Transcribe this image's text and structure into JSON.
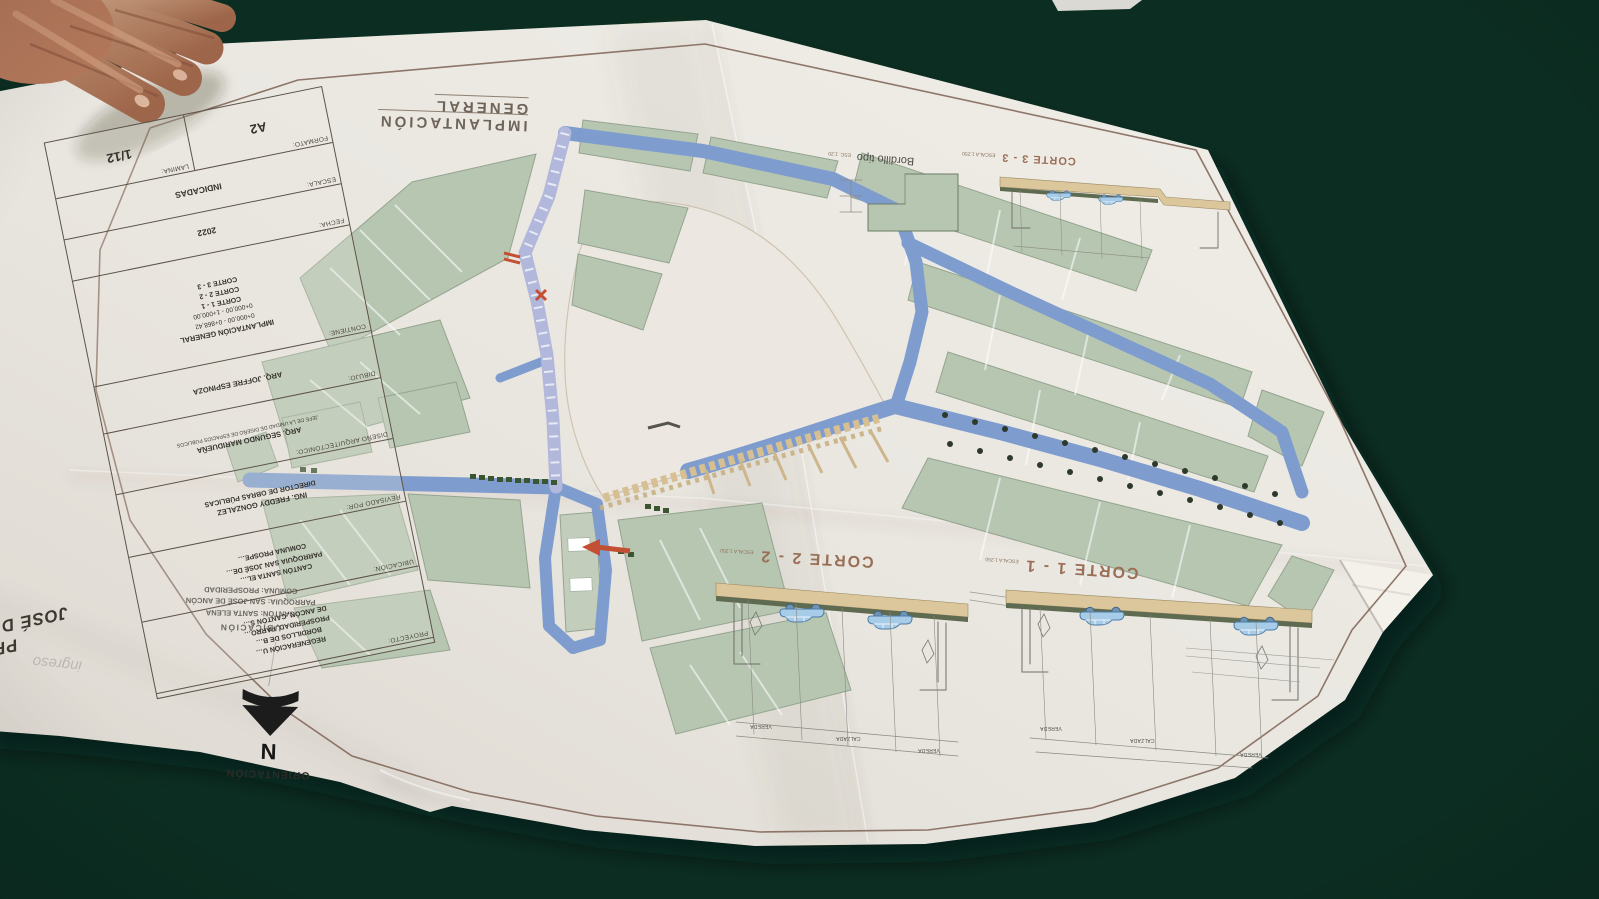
{
  "colors": {
    "table_felt": "#11402f",
    "paper": "#e9e5df",
    "street_blue": "#7e9dce",
    "regenerated_street": "#b2b8db",
    "block_green": "#b7c6b1",
    "promenade_tan": "#d6bf93",
    "frame_brown": "#7c6254",
    "red_marker": "#c35032"
  },
  "plan": {
    "map_title": "IMPLANTACIÓN GENERAL",
    "orientation": {
      "label": "ORIENTACIÓN",
      "north": "N"
    },
    "location_note": {
      "heading": "UBICACIÓN",
      "canton": "CANTÓN: SANTA ELENA",
      "parroquia": "PARROQUIA: SAN JOSÉ DE ANCÓN",
      "comuna": "COMUNA: PROSPERIDAD"
    },
    "faint_note": "ingreso",
    "sections": {
      "corte11": {
        "title": "CORTE 1 - 1",
        "scale": "ESCALA 1:250",
        "dims": [
          "VEREDA",
          "CALZADA",
          "VEREDA"
        ]
      },
      "corte22": {
        "title": "CORTE 2 - 2",
        "scale": "ESCALA 1:250",
        "dims": [
          "VEREDA",
          "CALZADA",
          "VEREDA"
        ]
      },
      "corte33": {
        "title": "CORTE 3 - 3",
        "scale": "ESCALA 1:250"
      },
      "bordillo": {
        "title": "Bordillo tipo",
        "scale": "ESC. 1:20"
      }
    },
    "title_block": {
      "lamina": {
        "label": "LAMINA:",
        "value": "1/12"
      },
      "formato": {
        "label": "FORMATO:",
        "value": "A2"
      },
      "escala": {
        "label": "ESCALA:",
        "value": "INDICADAS"
      },
      "fecha": {
        "label": "FECHA:",
        "value": "2022"
      },
      "contiene": {
        "label": "CONTIENE:",
        "lines": [
          "IMPLANTACIÓN GENERAL",
          "0+000,00 - 0+868,42",
          "0+000,00 - 1+000,00",
          "CORTE 1 - 1",
          "CORTE 2 - 2",
          "CORTE 3 - 3"
        ]
      },
      "dibujo": {
        "label": "DIBUJO:",
        "value": "ARQ. JOFFRE ESPINOZA"
      },
      "diseno": {
        "label": "DISEÑO ARQUITECTÓNICO:",
        "lines": [
          "ARQ. SEGUNDO MARIDUEÑA",
          "JEFE DE LA UNIDAD DE DISEÑO DE ESPACIOS PÚBLICOS"
        ]
      },
      "revisado": {
        "label": "REVISADO POR:",
        "lines": [
          "ING. FREDDY GONZALEZ",
          "DIRECTOR DE OBRAS PÚBLICAS"
        ]
      },
      "ubicacion": {
        "label": "UBICACIÓN:",
        "lines": [
          "CANTÓN SANTA EL…",
          "PARROQUIA SAN JOSÉ DE…",
          "COMUNA PROSPE…"
        ]
      },
      "proyecto": {
        "label": "PROYECTO:",
        "lines": [
          "REGENERACIÓN U…",
          "BORDILLOS DE B…",
          "PROSPERIDAD, PARRO…",
          "DE ANCÓN, CANTÓN S…"
        ]
      },
      "big_title_lines": [
        "PR…",
        "JOSÉ DA…"
      ]
    }
  }
}
